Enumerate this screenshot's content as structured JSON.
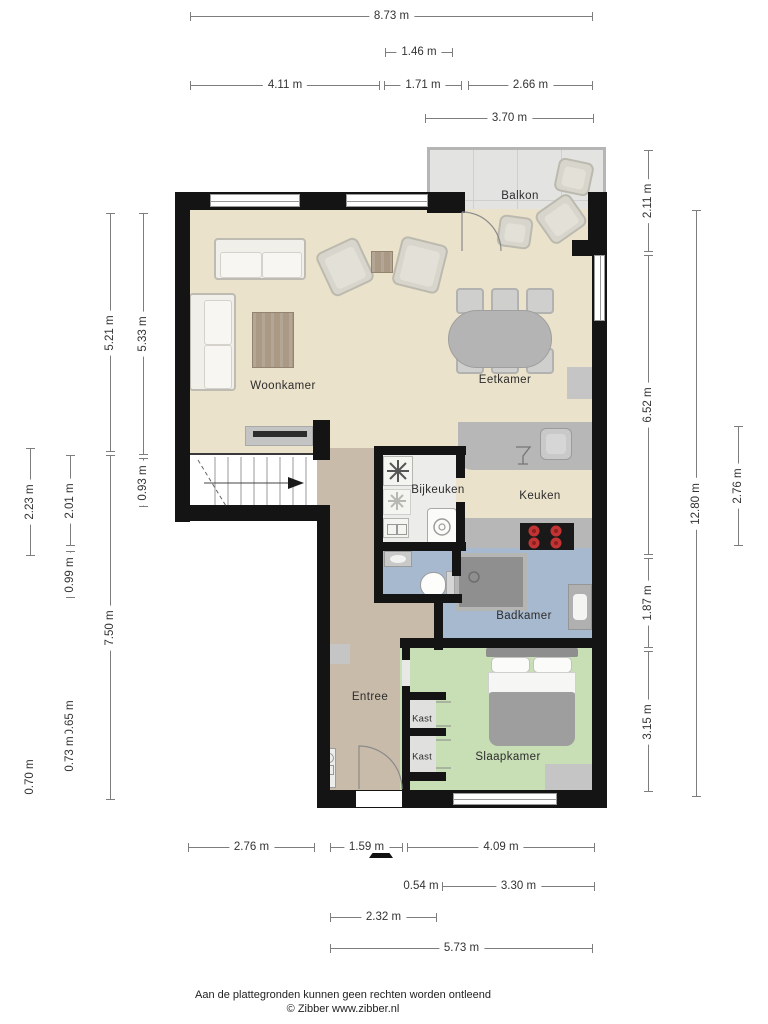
{
  "rooms": {
    "balkon": "Balkon",
    "woonkamer": "Woonkamer",
    "eetkamer": "Eetkamer",
    "keuken": "Keuken",
    "bijkeuken": "Bijkeuken",
    "badkamer": "Badkamer",
    "entree": "Entree",
    "slaapkamer": "Slaapkamer",
    "kast1": "Kast",
    "kast2": "Kast"
  },
  "dimensions": {
    "top": [
      "8.73 m",
      "1.46 m",
      "4.11 m",
      "1.71 m",
      "2.66 m",
      "3.70 m"
    ],
    "bottom": [
      "2.76 m",
      "1.59 m",
      "4.09 m",
      "0.54 m",
      "3.30 m",
      "2.32 m",
      "5.73 m"
    ],
    "left": [
      "5.21 m",
      "5.33 m",
      "2.23 m",
      "2.01 m",
      "0.93 m",
      "0.99 m",
      "7.50 m",
      "0.65 m",
      "0.73 m",
      "0.70 m"
    ],
    "right": [
      "2.11 m",
      "6.52 m",
      "12.80 m",
      "2.76 m",
      "1.87 m",
      "3.15 m"
    ]
  },
  "icons": {
    "washer": "washer-fan-icon",
    "dryer": "dryer-fan-icon",
    "stove": "four-burner-stove-icon",
    "shower_drain": "shower-drain-icon",
    "dishwasher": "wine-glass-icon",
    "north_marker": "entrance-triangle-icon"
  },
  "colors": {
    "wall": "#141414",
    "floor_living": "#ebe2cb",
    "floor_entree": "#c8bba9",
    "floor_bath": "#a7b9ce",
    "floor_bedroom": "#c8dfb5",
    "floor_balcony": "#e3e3e2",
    "floor_utility": "#ececea",
    "counter": "#b7b7b7",
    "stove_burner": "#c23434"
  },
  "footer": {
    "disclaimer": "Aan de plattegronden kunnen geen rechten worden ontleend",
    "credit": "© Zibber www.zibber.nl"
  }
}
